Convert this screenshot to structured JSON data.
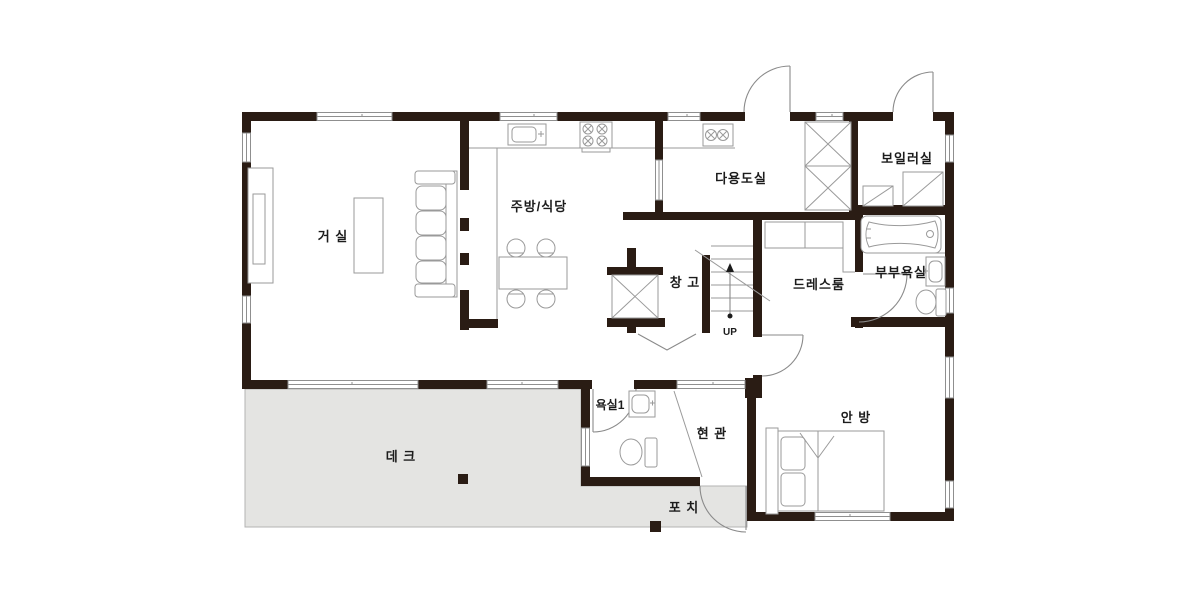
{
  "plan": {
    "type": "residential-floor-plan",
    "floor": "1F",
    "rooms": {
      "living": "거 실",
      "kitchen": "주방/식당",
      "utility": "다용도실",
      "boiler": "보일러실",
      "storage": "창 고",
      "dressroom": "드레스룸",
      "master_bath": "부부욕실",
      "bath1": "욕실1",
      "entrance": "현 관",
      "master_bedroom": "안 방",
      "deck": "데 크",
      "porch": "포 치"
    },
    "stairs": {
      "direction_label": "UP"
    },
    "colors": {
      "wall": "#2a1c14",
      "thin_line": "#9a9a9a",
      "deck_fill": "#e4e4e2",
      "label_text": "#1c1c1c",
      "background": "#ffffff"
    }
  }
}
